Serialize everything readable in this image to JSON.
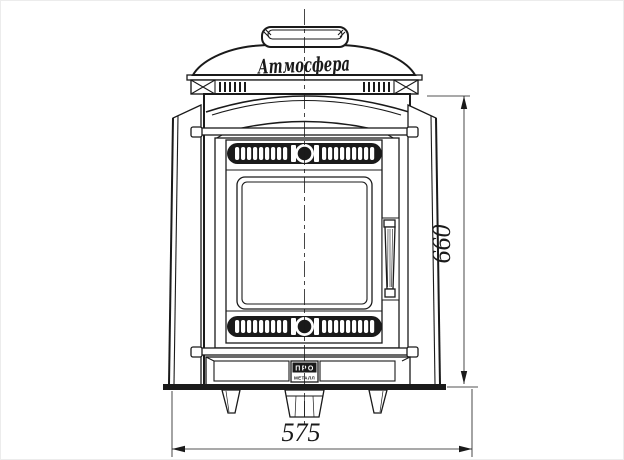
{
  "stove": {
    "brand_script": "Атмосфера",
    "badge": {
      "top": "ПРО",
      "bottom": "МЕТАЛЛ"
    }
  },
  "dimensions": {
    "width_mm": "575",
    "height_mm": "660"
  },
  "colors": {
    "line": "#1a1a1a",
    "background": "#ffffff"
  }
}
